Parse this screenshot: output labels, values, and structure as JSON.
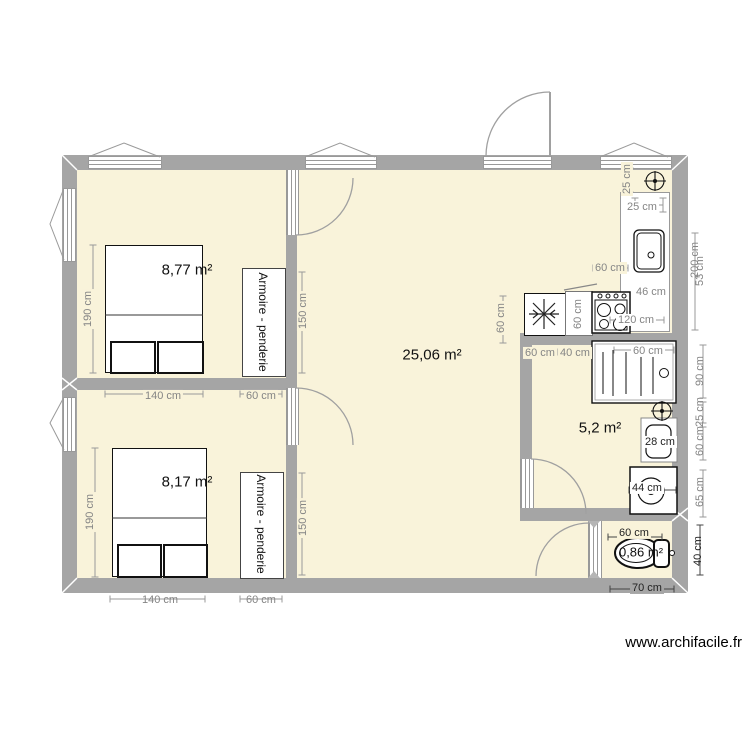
{
  "watermark": "www.archifacile.fr",
  "rooms": {
    "bedroom1": "8,77 m²",
    "bedroom2": "8,17 m²",
    "living": "25,06 m²",
    "bathroom": "5,2 m²",
    "wc": "0,86 m²"
  },
  "furniture": {
    "wardrobe1": "Armoire - penderie",
    "wardrobe2": "Armoire - penderie"
  },
  "dimensions": {
    "bed1_height": "190 cm",
    "bed2_height": "190 cm",
    "mid_140": "140 cm",
    "mid_60": "60 cm",
    "bottom_140": "140 cm",
    "bottom_60": "60 cm",
    "wardrobe1_150": "150 cm",
    "wardrobe2_150": "150 cm",
    "fridge_60": "60 cm",
    "cabinet_60": "60 cm",
    "stove_60": "60 cm",
    "sink_46": "46 cm",
    "counter_120": "120 cm",
    "counter_25": "25 cm",
    "counter_top_25": "25 cm",
    "right_200": "200 cm",
    "right_53": "53 cm",
    "bath_60": "60 cm",
    "bath_40": "40 cm",
    "shower_60": "60 cm",
    "basin_28": "28 cm",
    "washer_44": "44 cm",
    "wc_60": "60 cm",
    "right_90": "90 cm",
    "right_25": "25 cm",
    "right_60": "60 cm",
    "right_65": "65 cm",
    "wc_40": "40 cm",
    "wc_70": "70 cm"
  }
}
